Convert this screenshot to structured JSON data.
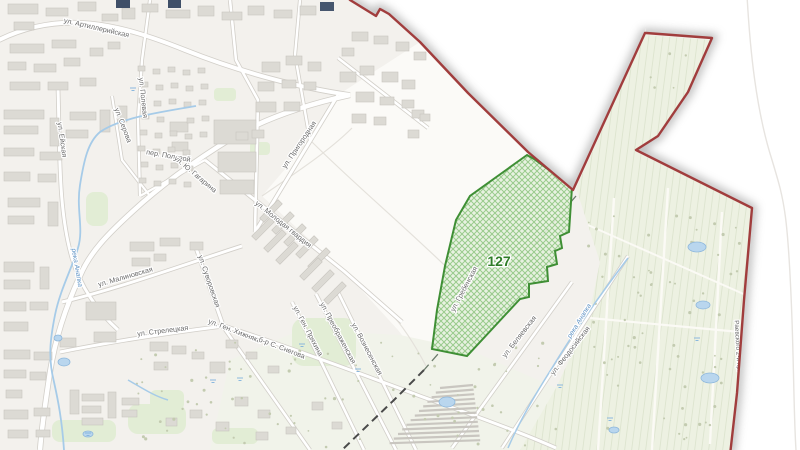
{
  "map": {
    "type": "cadastral-city-map",
    "parcel": {
      "number": "127"
    },
    "labels": [
      {
        "text": "ул. Артиллерийская",
        "x": 96,
        "y": 30,
        "rot": 13,
        "cls": ""
      },
      {
        "text": "ул. Полевая",
        "x": 141,
        "y": 98,
        "rot": 84,
        "cls": ""
      },
      {
        "text": "ул. Серова",
        "x": 121,
        "y": 126,
        "rot": 69,
        "cls": ""
      },
      {
        "text": "пер. Полевой",
        "x": 168,
        "y": 158,
        "rot": 10,
        "cls": ""
      },
      {
        "text": "ул. Ю. Гагарина",
        "x": 194,
        "y": 176,
        "rot": 40,
        "cls": ""
      },
      {
        "text": "ул. Ейская",
        "x": 60,
        "y": 140,
        "rot": 82,
        "cls": ""
      },
      {
        "text": "ул. Пригородная",
        "x": 301,
        "y": 146,
        "rot": -56,
        "cls": ""
      },
      {
        "text": "ул. Молодая гвардия",
        "x": 282,
        "y": 226,
        "rot": 39,
        "cls": ""
      },
      {
        "text": "ул. Малиновская",
        "x": 126,
        "y": 279,
        "rot": -16,
        "cls": ""
      },
      {
        "text": "ул. Суворовская",
        "x": 207,
        "y": 282,
        "rot": 71,
        "cls": ""
      },
      {
        "text": "ул. Стрелецкая",
        "x": 163,
        "y": 333,
        "rot": -7,
        "cls": ""
      },
      {
        "text": "ул. Ген. Хижняка",
        "x": 234,
        "y": 333,
        "rot": 21,
        "cls": ""
      },
      {
        "text": "б-р С. Снегова",
        "x": 281,
        "y": 350,
        "rot": 21,
        "cls": ""
      },
      {
        "text": "ул. Ген. Пряхина",
        "x": 306,
        "y": 332,
        "rot": 62,
        "cls": ""
      },
      {
        "text": "ул. Преображенская",
        "x": 336,
        "y": 334,
        "rot": 62,
        "cls": ""
      },
      {
        "text": "ул. Вознесенская",
        "x": 365,
        "y": 350,
        "rot": 62,
        "cls": ""
      },
      {
        "text": "ул. Гребенская",
        "x": 466,
        "y": 290,
        "rot": -62,
        "cls": ""
      },
      {
        "text": "ул. Беляевская",
        "x": 521,
        "y": 338,
        "rot": -52,
        "cls": ""
      },
      {
        "text": "ул. Феодосийская",
        "x": 572,
        "y": 352,
        "rot": -52,
        "cls": ""
      },
      {
        "text": "река Анапка",
        "x": 75,
        "y": 268,
        "rot": 80,
        "cls": "water"
      },
      {
        "text": "река Анапка",
        "x": 581,
        "y": 322,
        "rot": -58,
        "cls": "water"
      },
      {
        "text": "Раевского 2-й пр.",
        "x": 736,
        "y": 346,
        "rot": 87,
        "cls": "small"
      },
      {
        "text": "127",
        "x": 499,
        "y": 266,
        "rot": 0,
        "cls": "parcel"
      }
    ],
    "colors": {
      "boundary_red": "#a13d3d",
      "parcel_border_green": "#3f8f35",
      "parcel_fill_green": "#e6f1de",
      "field_green": "#edf1e2",
      "water_blue": "#a6cbe8",
      "building_gray": "#dcdad4",
      "label_gray": "#6a6a6a"
    }
  }
}
